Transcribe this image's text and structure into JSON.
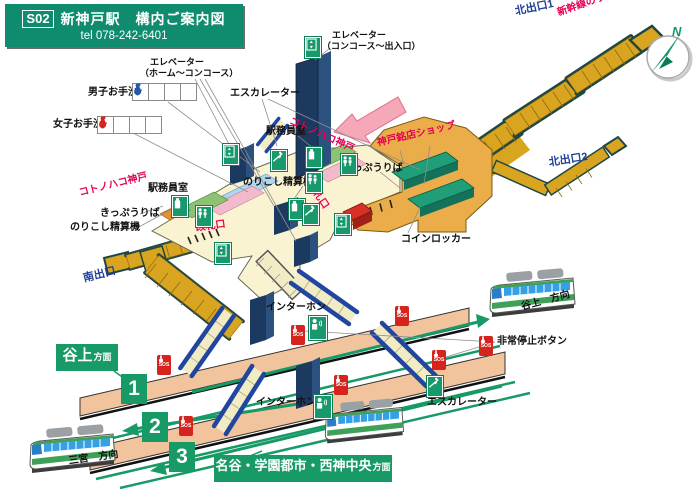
{
  "header": {
    "code": "S02",
    "title": "新神戸駅　構内ご案内図",
    "tel": "tel 078-242-6401"
  },
  "compass": {
    "north": "N"
  },
  "labels": {
    "elevator_home": "エレベーター",
    "elevator_home_sub": "（ホーム〜コンコース）",
    "elevator_gate": "エレベーター",
    "elevator_gate_sub": "（コンコース〜出入口）",
    "mens_toilet": "男子お手洗",
    "womens_toilet": "女子お手洗",
    "escalator_top": "エスカレーター",
    "escalator_bottom": "エスカレーター",
    "office_upper": "駅務員室",
    "office_left": "駅務員室",
    "kotonohako_upper": "コトノハコ神戸",
    "kotonohako_left": "コトノハコ神戸",
    "meiten_shop": "神戸銘店ショップ",
    "tickets_right": "きっぷうりば",
    "tickets_left": "きっぷうりば",
    "fare_adjust_right": "のりこし精算機",
    "fare_adjust_left": "のりこし精算機",
    "gate_right": "改札口",
    "gate_left": "改札口",
    "coin_lockers": "コインロッカー",
    "north_exit1": "北出口1",
    "north_exit2": "北出口2",
    "south_exit": "南出口",
    "shinkansen": "新幹線のりば",
    "intercom_upper": "インターホン",
    "intercom_lower": "インターホン",
    "emergency_stop": "非常停止ボタン",
    "tanigami_direction": "谷上　方向",
    "sannomiya_direction": "三宮　方向"
  },
  "direction_boxes": {
    "tanigami": {
      "main": "谷上",
      "suffix": "方面"
    },
    "seishin": {
      "main": "名谷・学園都市・西神中央",
      "suffix": "方面"
    }
  },
  "platform_numbers": {
    "p1": "1",
    "p2": "2",
    "p3": "3"
  },
  "sos": {
    "label": "SOS"
  },
  "icons": {
    "mens_row": [
      "man",
      "wheelchair",
      "child",
      "bag"
    ],
    "womens_row": [
      "woman",
      "wheelchair",
      "child",
      "bag"
    ],
    "facility_signs": [
      "elevator",
      "escalator",
      "ticket-machine",
      "staff",
      "intercom"
    ]
  },
  "colors": {
    "header_green": "#0F8C6D",
    "accent_green": "#179A66",
    "stair_gold": "#D9A520",
    "stair_edge_teal": "#1E4744",
    "floor_cream": "#FAF3D2",
    "floor_orange": "#EBAD49",
    "platform_salmon": "#F2C49E",
    "escalator_blue": "#2046A0",
    "elevator_navy": "#1C3A60",
    "sos_red": "#D6231E",
    "label_red": "#E60055",
    "label_blue": "#1D3F96",
    "shop_teal": "#1F9E78",
    "pink_arrow": "#F5A9B8",
    "train_green": "#3FA058",
    "train_window_blue": "#35A0E8"
  }
}
